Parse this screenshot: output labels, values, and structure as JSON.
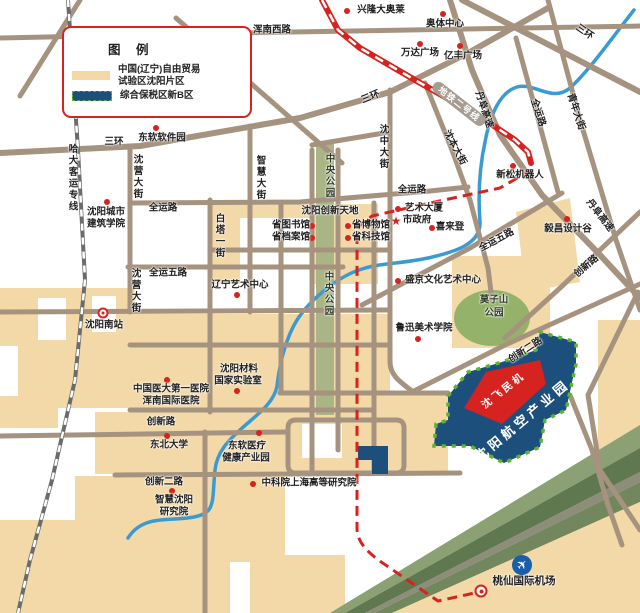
{
  "map": {
    "title": "中国(辽宁)自由贸易试验区沈阳片区地图",
    "legend": {
      "title": "图 例",
      "items": [
        {
          "lines": [
            "中国(辽宁)自由贸易",
            "试验区沈阳片区"
          ],
          "swatch": "#f3d9a7"
        },
        {
          "lines": [
            "综合保税区新B区",
            ""
          ],
          "swatch": "#1d4f7c"
        }
      ]
    },
    "colors": {
      "zone_tan": "#f3d9a7",
      "road": "#a6937f",
      "park_green": "#a9b584",
      "hill_green": "#95b26a",
      "water_blue": "#3a9ad2",
      "metro_red": "#d6231f",
      "bonded_blue": "#1d4f7c",
      "dash_green": "#5cb531",
      "airport_blue": "#1a5dab"
    },
    "labels": [
      {
        "text": "浑南西路",
        "x": 272,
        "y": 31
      },
      {
        "text": "金阳大街",
        "x": 233,
        "y": 68,
        "rot": 50
      },
      {
        "text": "三环",
        "x": 584,
        "y": 33,
        "rot": 35
      },
      {
        "text": "三环",
        "x": 371,
        "y": 98,
        "rot": -22
      },
      {
        "text": "三环",
        "x": 114,
        "y": 143
      },
      {
        "text": "哈大客运专线",
        "x": 71,
        "y": 178,
        "vertical": true
      },
      {
        "text": "东软软件园",
        "x": 162,
        "y": 139
      },
      {
        "text": "沈营大街",
        "x": 136,
        "y": 177,
        "vertical": true
      },
      {
        "text": "沈营大街",
        "x": 134,
        "y": 291,
        "vertical": true
      },
      {
        "text": "智慧大街",
        "x": 259,
        "y": 178,
        "vertical": true
      },
      {
        "text": "白塔一街",
        "x": 218,
        "y": 236,
        "vertical": true
      },
      {
        "text": "中央公园",
        "x": 328,
        "y": 176,
        "vertical": true,
        "cls": "park-lbl"
      },
      {
        "text": "中央公园",
        "x": 327,
        "y": 294,
        "vertical": true,
        "cls": "park-lbl"
      },
      {
        "text": "沈中大街",
        "x": 382,
        "y": 147,
        "vertical": true
      },
      {
        "text": "全运路",
        "x": 163,
        "y": 209
      },
      {
        "text": "全运路",
        "x": 412,
        "y": 191
      },
      {
        "text": "全运路",
        "x": 537,
        "y": 113,
        "rot": 72
      },
      {
        "text": "青年大街",
        "x": 575,
        "y": 112,
        "rot": 72
      },
      {
        "text": "丹阜高速",
        "x": 483,
        "y": 110,
        "rot": 72
      },
      {
        "text": "丹阜高速",
        "x": 599,
        "y": 216,
        "rot": 52
      },
      {
        "text": "地铁二号线",
        "x": 459,
        "y": 104,
        "rot": 38,
        "cls": "metro-pill"
      },
      {
        "text": "沈本大街",
        "x": 454,
        "y": 148,
        "rot": 62
      },
      {
        "text": "新松机器人",
        "x": 520,
        "y": 176
      },
      {
        "text": "全运五路",
        "x": 168,
        "y": 274
      },
      {
        "text": "全运五路",
        "x": 497,
        "y": 241,
        "rot": -28
      },
      {
        "text": "沈阳创新天地",
        "x": 330,
        "y": 212
      },
      {
        "text": "省图书馆",
        "x": 291,
        "y": 226
      },
      {
        "text": "省档案馆",
        "x": 291,
        "y": 238
      },
      {
        "text": "省博物馆",
        "x": 371,
        "y": 226
      },
      {
        "text": "省科技馆",
        "x": 371,
        "y": 238
      },
      {
        "text": "艺术大厦",
        "x": 424,
        "y": 209
      },
      {
        "text": "市政府",
        "x": 417,
        "y": 221
      },
      {
        "text": "喜来登",
        "x": 450,
        "y": 228
      },
      {
        "text": "盛京文化艺术中心",
        "x": 443,
        "y": 281
      },
      {
        "text": "莫子山",
        "x": 494,
        "y": 301,
        "cls": "park-lbl"
      },
      {
        "text": "公园",
        "x": 494,
        "y": 314,
        "cls": "park-lbl"
      },
      {
        "text": "鲁迅美术学院",
        "x": 424,
        "y": 329
      },
      {
        "text": "毅昌设计谷",
        "x": 568,
        "y": 230
      },
      {
        "text": "创新路",
        "x": 587,
        "y": 267,
        "rot": -40
      },
      {
        "text": "创新二路",
        "x": 526,
        "y": 351,
        "rot": -33
      },
      {
        "text": "创新路",
        "x": 161,
        "y": 423
      },
      {
        "text": "东北大学",
        "x": 169,
        "y": 446
      },
      {
        "text": "东软医疗",
        "x": 247,
        "y": 447
      },
      {
        "text": "健康产业园",
        "x": 246,
        "y": 459
      },
      {
        "text": "创新二路",
        "x": 164,
        "y": 483
      },
      {
        "text": "智慧沈阳",
        "x": 174,
        "y": 501
      },
      {
        "text": "研究院",
        "x": 174,
        "y": 513
      },
      {
        "text": "中科院上海高等研究院",
        "x": 309,
        "y": 484
      },
      {
        "text": "沈阳南站",
        "x": 104,
        "y": 326
      },
      {
        "text": "中国医大第一医院",
        "x": 171,
        "y": 390
      },
      {
        "text": "浑南国际医院",
        "x": 171,
        "y": 402
      },
      {
        "text": "沈阳材料",
        "x": 239,
        "y": 370
      },
      {
        "text": "国家实验室",
        "x": 238,
        "y": 382
      },
      {
        "text": "沈阳城市",
        "x": 106,
        "y": 213
      },
      {
        "text": "建筑学院",
        "x": 106,
        "y": 225
      },
      {
        "text": "兴隆大奥莱",
        "x": 381,
        "y": 11
      },
      {
        "text": "奥体中心",
        "x": 445,
        "y": 25
      },
      {
        "text": "万达广场",
        "x": 420,
        "y": 54
      },
      {
        "text": "亿丰广场",
        "x": 463,
        "y": 57
      },
      {
        "text": "辽宁艺术中心",
        "x": 240,
        "y": 286
      },
      {
        "text": "桃仙国际机场",
        "x": 524,
        "y": 581,
        "cls": "airport-lbl"
      },
      {
        "text": "沈飞民机",
        "x": 504,
        "y": 391,
        "rot": -38,
        "cls": "zone-red-lbl"
      },
      {
        "text": "沈阳航空产业园",
        "x": 523,
        "y": 421,
        "rot": -40,
        "cls": "zone-blue-lbl"
      }
    ],
    "markers": [
      {
        "type": "dot",
        "x": 156,
        "y": 128,
        "for": "东软软件园"
      },
      {
        "type": "dot",
        "x": 107,
        "y": 202,
        "for": "沈阳城市建筑学院"
      },
      {
        "type": "dot",
        "x": 513,
        "y": 166,
        "for": "新松机器人"
      },
      {
        "type": "dot",
        "x": 312,
        "y": 226,
        "for": "省图书馆"
      },
      {
        "type": "dot",
        "x": 312,
        "y": 238,
        "for": "省档案馆"
      },
      {
        "type": "dot",
        "x": 348,
        "y": 226,
        "for": "省博物馆"
      },
      {
        "type": "dot",
        "x": 348,
        "y": 238,
        "for": "省科技馆"
      },
      {
        "type": "dot",
        "x": 398,
        "y": 209,
        "for": "艺术大厦"
      },
      {
        "type": "star",
        "x": 396,
        "y": 221,
        "for": "市政府"
      },
      {
        "type": "dot",
        "x": 432,
        "y": 228,
        "for": "喜来登"
      },
      {
        "type": "dot",
        "x": 398,
        "y": 281,
        "for": "盛京文化艺术中心"
      },
      {
        "type": "dot",
        "x": 418,
        "y": 339,
        "for": "鲁迅美术学院"
      },
      {
        "type": "dot",
        "x": 567,
        "y": 219,
        "for": "毅昌设计谷"
      },
      {
        "type": "dot",
        "x": 237,
        "y": 295,
        "for": "辽宁艺术中心"
      },
      {
        "type": "dot",
        "x": 167,
        "y": 380,
        "for": "中国医大第一医院"
      },
      {
        "type": "dot",
        "x": 237,
        "y": 391,
        "for": "沈阳材料国家实验室"
      },
      {
        "type": "dot",
        "x": 167,
        "y": 436,
        "for": "东北大学"
      },
      {
        "type": "dot",
        "x": 259,
        "y": 433,
        "for": "东软医疗健康产业园"
      },
      {
        "type": "dot",
        "x": 172,
        "y": 491,
        "for": "智慧沈阳研究院"
      },
      {
        "type": "dot",
        "x": 253,
        "y": 484,
        "for": "中科院上海高等研究院"
      },
      {
        "type": "dot",
        "x": 347,
        "y": 11,
        "for": "兴隆大奥莱"
      },
      {
        "type": "dot",
        "x": 443,
        "y": 14,
        "for": "奥体中心"
      },
      {
        "type": "dot",
        "x": 420,
        "y": 44,
        "for": "万达广场"
      },
      {
        "type": "dot",
        "x": 460,
        "y": 46,
        "for": "亿丰广场"
      },
      {
        "type": "station",
        "x": 103,
        "y": 313,
        "for": "沈阳南站"
      },
      {
        "type": "airport",
        "x": 522,
        "y": 565,
        "for": "桃仙国际机场"
      },
      {
        "type": "metro",
        "x": 481,
        "y": 591,
        "for": "机场地铁站"
      }
    ]
  }
}
